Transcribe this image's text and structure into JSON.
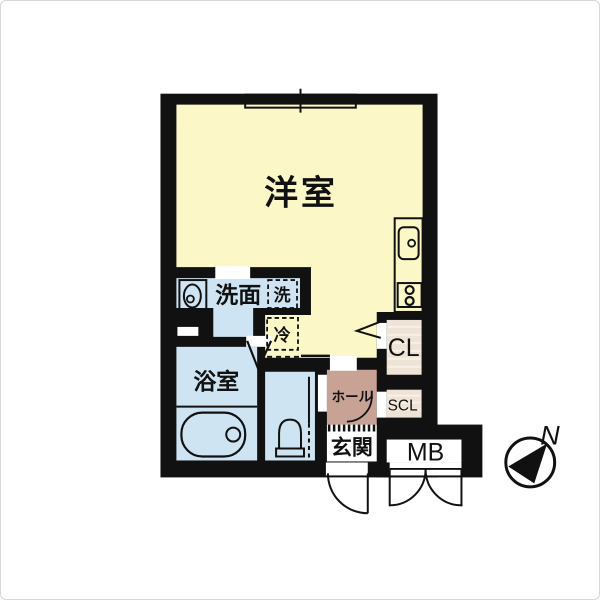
{
  "labels": {
    "western_room": "洋室",
    "washroom": "洗面",
    "washer": "洗",
    "fridge": "冷",
    "bathroom": "浴室",
    "hall": "ホール",
    "entrance": "玄関",
    "closet": "CL",
    "shoe_closet": "SCL",
    "meter_box": "MB",
    "north": "N"
  },
  "colors": {
    "wall_black": "#111111",
    "room_yellow": "#FBF7C6",
    "wet_area_blue": "#CFE4F2",
    "hall_brown": "#C9A296",
    "closet_beige": "#EFE3D6"
  }
}
